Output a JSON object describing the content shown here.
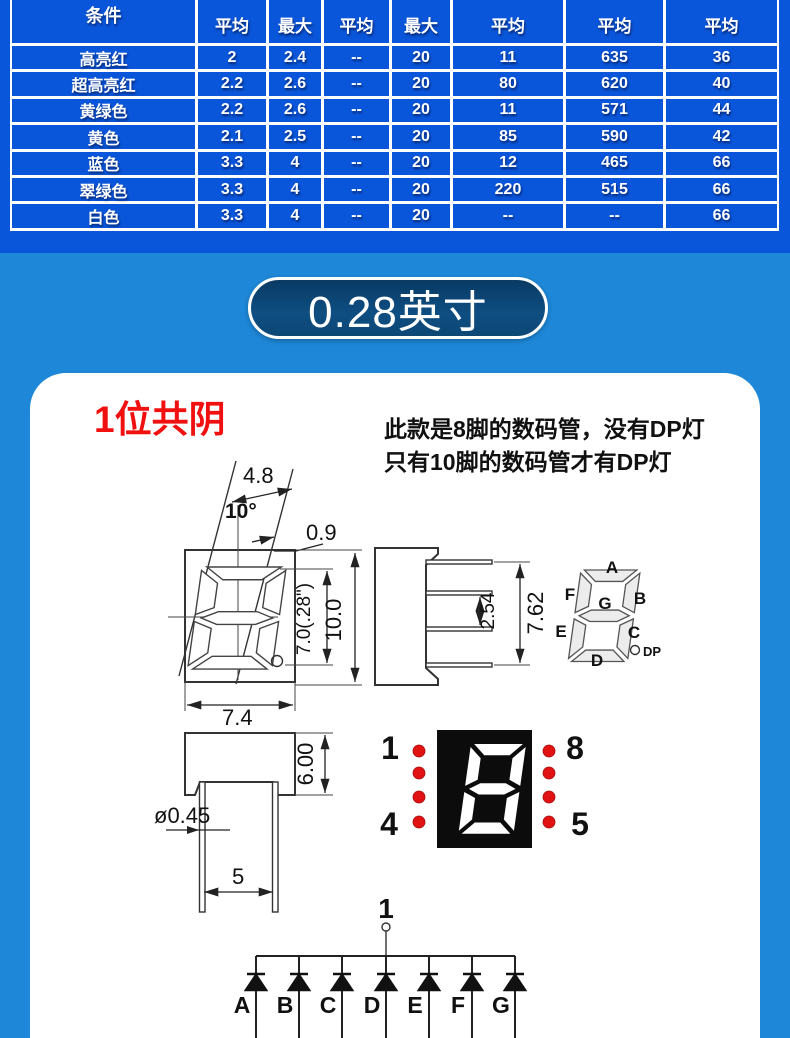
{
  "table": {
    "header": [
      "条件",
      "平均",
      "最大",
      "平均",
      "最大",
      "平均",
      "平均",
      "平均"
    ],
    "rows": [
      {
        "label": "高亮红",
        "cells": [
          "2",
          "2.4",
          "--",
          "20",
          "11",
          "635",
          "36"
        ]
      },
      {
        "label": "超高亮红",
        "cells": [
          "2.2",
          "2.6",
          "--",
          "20",
          "80",
          "620",
          "40"
        ]
      },
      {
        "label": "黄绿色",
        "cells": [
          "2.2",
          "2.6",
          "--",
          "20",
          "11",
          "571",
          "44"
        ]
      },
      {
        "label": "黄色",
        "cells": [
          "2.1",
          "2.5",
          "--",
          "20",
          "85",
          "590",
          "42"
        ]
      },
      {
        "label": "蓝色",
        "cells": [
          "3.3",
          "4",
          "--",
          "20",
          "12",
          "465",
          "66"
        ]
      },
      {
        "label": "翠绿色",
        "cells": [
          "3.3",
          "4",
          "--",
          "20",
          "220",
          "515",
          "66"
        ]
      },
      {
        "label": "白色",
        "cells": [
          "3.3",
          "4",
          "--",
          "20",
          "--",
          "--",
          "66"
        ]
      }
    ]
  },
  "banner": {
    "label": "0.28英寸"
  },
  "card": {
    "title": "1位共阴",
    "note_line1": "此款是8脚的数码管，没有DP灯",
    "note_line2": "只有10脚的数码管才有DP灯"
  },
  "front_view": {
    "dim_top_width": "4.8",
    "dim_angle": "10°",
    "dim_offset": "0.9",
    "dim_digit_height": "7.0(.28\")",
    "dim_height": "10.0",
    "dim_width": "7.4"
  },
  "side_view": {
    "dim_pin_pitch": "2.54",
    "dim_pin_span": "7.62"
  },
  "segment_diagram": {
    "labels": {
      "a": "A",
      "b": "B",
      "c": "C",
      "d": "D",
      "e": "E",
      "f": "F",
      "g": "G"
    },
    "dp": "DP"
  },
  "bottom_view": {
    "dim_height": "6.00",
    "dim_pin_diameter": "ø0.45",
    "dim_pin_spacing": "5"
  },
  "display": {
    "pin_top_left": "1",
    "pin_top_right": "8",
    "pin_bottom_left": "4",
    "pin_bottom_right": "5"
  },
  "circuit": {
    "common_pin": "1",
    "diodes": [
      "A",
      "B",
      "C",
      "D",
      "E",
      "F",
      "G"
    ]
  },
  "colors": {
    "table_blue": "#0a56da",
    "mid_blue": "#1e87d7",
    "pill_navy": "#0d4a7c",
    "accent_red": "#f01010",
    "led_dot_red": "#e01212",
    "display_black": "#0c0c0c"
  }
}
